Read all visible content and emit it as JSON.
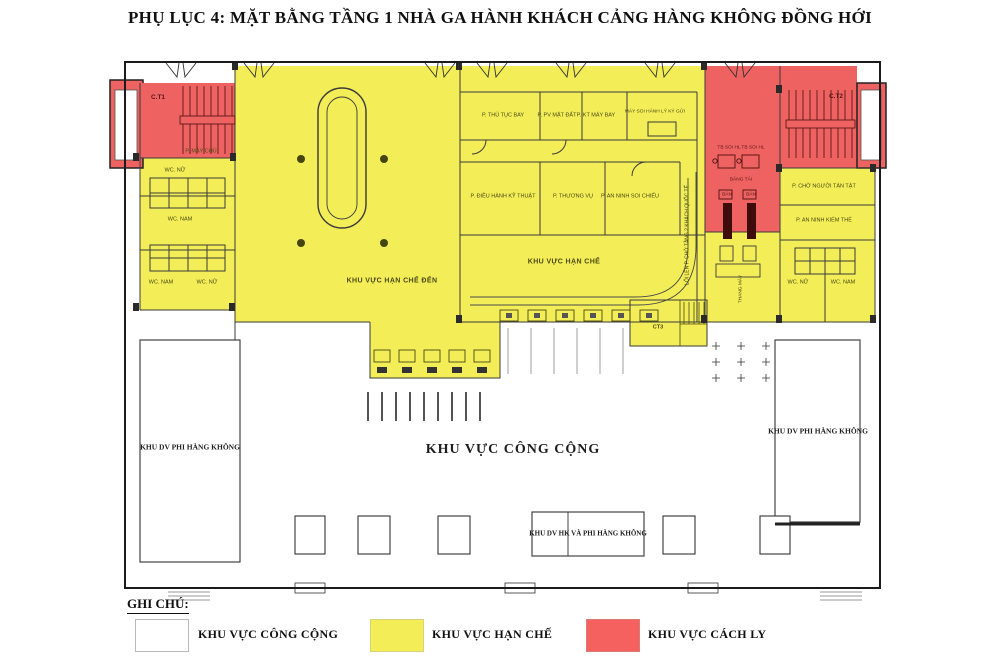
{
  "title": "PHỤ LỤC 4: MẶT BẰNG TẦNG 1 NHÀ GA HÀNH KHÁCH CẢNG HÀNG KHÔNG ĐỒNG HỚI",
  "colors": {
    "restricted": "#F3ED58",
    "isolation": "#EE6361",
    "public": "#FFFFFF",
    "wall": "#2B2B2B"
  },
  "plan": {
    "labels": {
      "ct1": "C.T1",
      "ct2": "C.T2",
      "ct3": "CT3",
      "server_room": "P. MÁY CHỦ",
      "wc_nu_upper": "WC. NỮ",
      "wc_nam_upper": "WC. NAM",
      "wc_nam_lower": "WC. NAM",
      "wc_nu_lower": "WC. NỮ",
      "arrival_hall": "KHU VỰC HẠN CHẾ ĐẾN",
      "flight_procedures": "P. THỦ TỤC BAY",
      "ground_services": "P. PV MẶT ĐẤT",
      "aircraft_tech": "P. KT MÁY BAY",
      "checked_baggage_scanner": "MÁY SOI HÀNH LÝ KÝ GỬI",
      "tech_operations": "P. ĐIỀU HÀNH KỸ THUẬT",
      "commercial": "P. THƯƠNG VỤ",
      "security_screening": "P. AN NINH SOI CHIẾU",
      "restricted_hall": "KHU VỰC HẠN CHẾ",
      "level2_access": "LỐI LÊN P. CHỜ TẦNG 2 KHÁCH QUỐC TẾ",
      "scanner_left": "TB SOI HL",
      "scanner_right": "TB SOI HL",
      "conveyor": "BĂNG TẢI",
      "desk_left": "BÀN",
      "desk_right": "BÀN",
      "disabled_waiting": "P. CHỜ NGƯỜI TÀN TẬT",
      "body_search": "P. AN NINH KIỂM THỂ",
      "wc_nu_right": "WC. NỮ",
      "wc_nam_right": "WC. NAM",
      "elevator": "THANG MÁY",
      "nonaviation_left": "KHU DV PHI HÀNG KHÔNG",
      "public_hall": "KHU VỰC CÔNG CỘNG",
      "nonaviation_right": "KHU DV PHI HÀNG KHÔNG",
      "mixed_services": "KHU DV HK VÀ PHI HÀNG KHÔNG"
    }
  },
  "legend": {
    "heading": "GHI CHÚ:",
    "items": [
      {
        "label": "KHU VỰC CÔNG CỘNG",
        "color": "#FFFFFF"
      },
      {
        "label": "KHU VỰC HẠN CHẾ",
        "color": "#F3ED58"
      },
      {
        "label": "KHU VỰC CÁCH LY",
        "color": "#F4615E"
      }
    ]
  }
}
